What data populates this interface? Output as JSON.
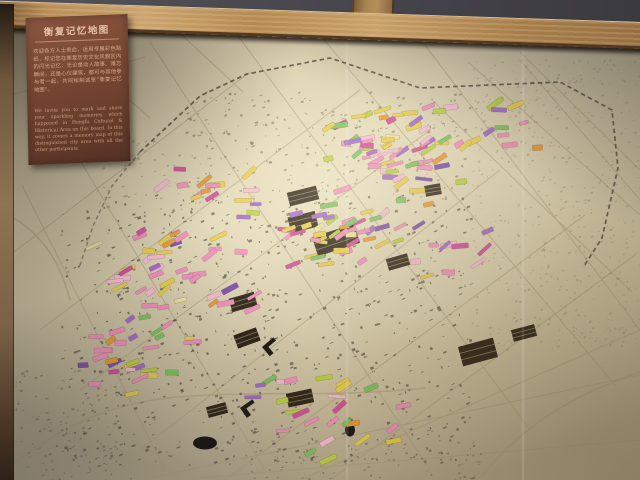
{
  "scene": {
    "description": "Photograph of a museum wall map (Hengfu historic area, Shanghai) covered with colorful memory sticker flags, framed in wood",
    "plaque": {
      "title": "衡复记忆地图",
      "body_cn": "欢迎各方人士来此，运用专属彩色贴纸，标记您在衡复历史文化风貌区内的闪光记忆：无论是动人故事、难忘瞬间，还是心仪建筑，都可与其他参与者一起，共同绘制这张“衡复记忆地图”。",
      "body_en": "We invite you to mark and share your sparkling memories which happened in Hengfu Cultural & Historical Area on this board. In this way, it covers a memory map of this distinguished city area with all the other participants."
    }
  },
  "colors": {
    "wall_dark": "#39383e",
    "beam_light": "#caa46e",
    "beam_dark": "#8f6a3e",
    "frame_wood": "#8d7453",
    "plaque_bg": "#7a4833",
    "plaque_text": "#d8b496",
    "paper_light": "#ece2c4",
    "paper_dark": "#aea288",
    "road": "#ab9a78",
    "boundary": "#4a4238",
    "building": "#5f584a"
  },
  "map": {
    "roads": [
      [
        40,
        330,
        360,
        90
      ],
      [
        80,
        390,
        430,
        130
      ],
      [
        140,
        450,
        500,
        170
      ],
      [
        225,
        480,
        585,
        215
      ],
      [
        10,
        255,
        250,
        72
      ],
      [
        330,
        480,
        635,
        255
      ],
      [
        300,
        480,
        640,
        330
      ],
      [
        150,
        42,
        430,
        470
      ],
      [
        235,
        32,
        530,
        430
      ],
      [
        320,
        35,
        615,
        385
      ],
      [
        65,
        135,
        265,
        470
      ],
      [
        425,
        45,
        640,
        330
      ],
      [
        22,
        185,
        165,
        470
      ],
      [
        520,
        60,
        640,
        200
      ],
      [
        0,
        98,
        145,
        57
      ],
      [
        28,
        12,
        150,
        118
      ],
      [
        155,
        10,
        243,
        92
      ],
      [
        468,
        62,
        640,
        215
      ],
      [
        520,
        52,
        640,
        170
      ],
      [
        432,
        100,
        632,
        292
      ],
      [
        150,
        478,
        640,
        375
      ],
      [
        200,
        478,
        640,
        440
      ]
    ],
    "curves": [
      "M14,464 C70,420 118,402 178,397 C260,390 330,398 425,388",
      "M0,210 C40,230 60,260 70,300",
      "M480,478 C520,430 560,400 640,372"
    ],
    "boundary_dashed": "M140,152 L200,96 L247,74 L330,58 L420,88 L560,82 L612,110 L618,168 L602,238 L584,266",
    "boundary_left": "M140,152 L112,186 L93,226 L79,268",
    "landmarks": {
      "hatch": [
        [
          303,
          196,
          30,
          14,
          -14
        ],
        [
          303,
          222,
          28,
          16,
          -14
        ],
        [
          336,
          240,
          44,
          20,
          -18
        ],
        [
          243,
          302,
          26,
          14,
          -16
        ],
        [
          247,
          338,
          24,
          14,
          -20
        ],
        [
          300,
          398,
          26,
          14,
          -12
        ],
        [
          217,
          410,
          20,
          11,
          -15
        ],
        [
          433,
          190,
          16,
          11,
          -10
        ],
        [
          478,
          352,
          36,
          20,
          -15
        ],
        [
          524,
          333,
          24,
          12,
          -15
        ],
        [
          398,
          262,
          22,
          12,
          -16
        ]
      ],
      "oval": [
        [
          205,
          443,
          24,
          13
        ],
        [
          350,
          430,
          10,
          13
        ]
      ],
      "angle": [
        [
          262,
          347,
          -40
        ],
        [
          240,
          408,
          -35
        ]
      ]
    },
    "speckles": [
      {
        "x": 60,
        "y": 195,
        "w": 410,
        "h": 270,
        "count": 750,
        "size": 3,
        "rot": -20,
        "color": "#5f584a",
        "opacity": 0.75,
        "seed": 11
      },
      {
        "x": 185,
        "y": 92,
        "w": 285,
        "h": 110,
        "count": 260,
        "size": 2.6,
        "rot": -20,
        "color": "#7b7260",
        "opacity": 0.6,
        "seed": 12
      },
      {
        "x": 470,
        "y": 60,
        "w": 170,
        "h": 290,
        "count": 550,
        "size": 2,
        "rot": -28,
        "color": "#9a9078",
        "opacity": 0.5,
        "seed": 13
      },
      {
        "x": 15,
        "y": 370,
        "w": 115,
        "h": 110,
        "count": 120,
        "size": 2.6,
        "rot": -12,
        "color": "#6d665a",
        "opacity": 0.6,
        "seed": 14
      },
      {
        "x": 95,
        "y": 140,
        "w": 120,
        "h": 70,
        "count": 60,
        "size": 2.2,
        "rot": -18,
        "color": "#857c68",
        "opacity": 0.5,
        "seed": 15
      },
      {
        "x": 230,
        "y": 440,
        "w": 250,
        "h": 40,
        "count": 90,
        "size": 2.4,
        "rot": -12,
        "color": "#6d665a",
        "opacity": 0.6,
        "seed": 16
      }
    ],
    "flags": {
      "palette": [
        [
          "#f291bd",
          30
        ],
        [
          "#f7bcd4",
          8
        ],
        [
          "#d4509e",
          7
        ],
        [
          "#a46cc8",
          12
        ],
        [
          "#7d4fae",
          5
        ],
        [
          "#e9cf4e",
          22
        ],
        [
          "#bcd243",
          8
        ],
        [
          "#7dc462",
          8
        ],
        [
          "#e89b33",
          5
        ],
        [
          "#efe3a0",
          4
        ]
      ],
      "clusters": [
        {
          "cx": 390,
          "cy": 152,
          "rx": 78,
          "ry": 48,
          "count": 60,
          "seed": 1
        },
        {
          "cx": 505,
          "cy": 128,
          "rx": 48,
          "ry": 38,
          "count": 10,
          "seed": 2
        },
        {
          "cx": 330,
          "cy": 230,
          "rx": 100,
          "ry": 42,
          "count": 48,
          "seed": 3
        },
        {
          "cx": 178,
          "cy": 268,
          "rx": 88,
          "ry": 50,
          "count": 42,
          "seed": 4
        },
        {
          "cx": 140,
          "cy": 352,
          "rx": 70,
          "ry": 46,
          "count": 30,
          "seed": 5
        },
        {
          "cx": 330,
          "cy": 412,
          "rx": 88,
          "ry": 52,
          "count": 26,
          "seed": 6
        },
        {
          "cx": 212,
          "cy": 178,
          "rx": 52,
          "ry": 30,
          "count": 12,
          "seed": 7
        },
        {
          "cx": 452,
          "cy": 252,
          "rx": 42,
          "ry": 52,
          "count": 12,
          "seed": 8
        },
        {
          "cx": 448,
          "cy": 128,
          "rx": 30,
          "ry": 30,
          "count": 6,
          "seed": 9
        }
      ]
    }
  }
}
